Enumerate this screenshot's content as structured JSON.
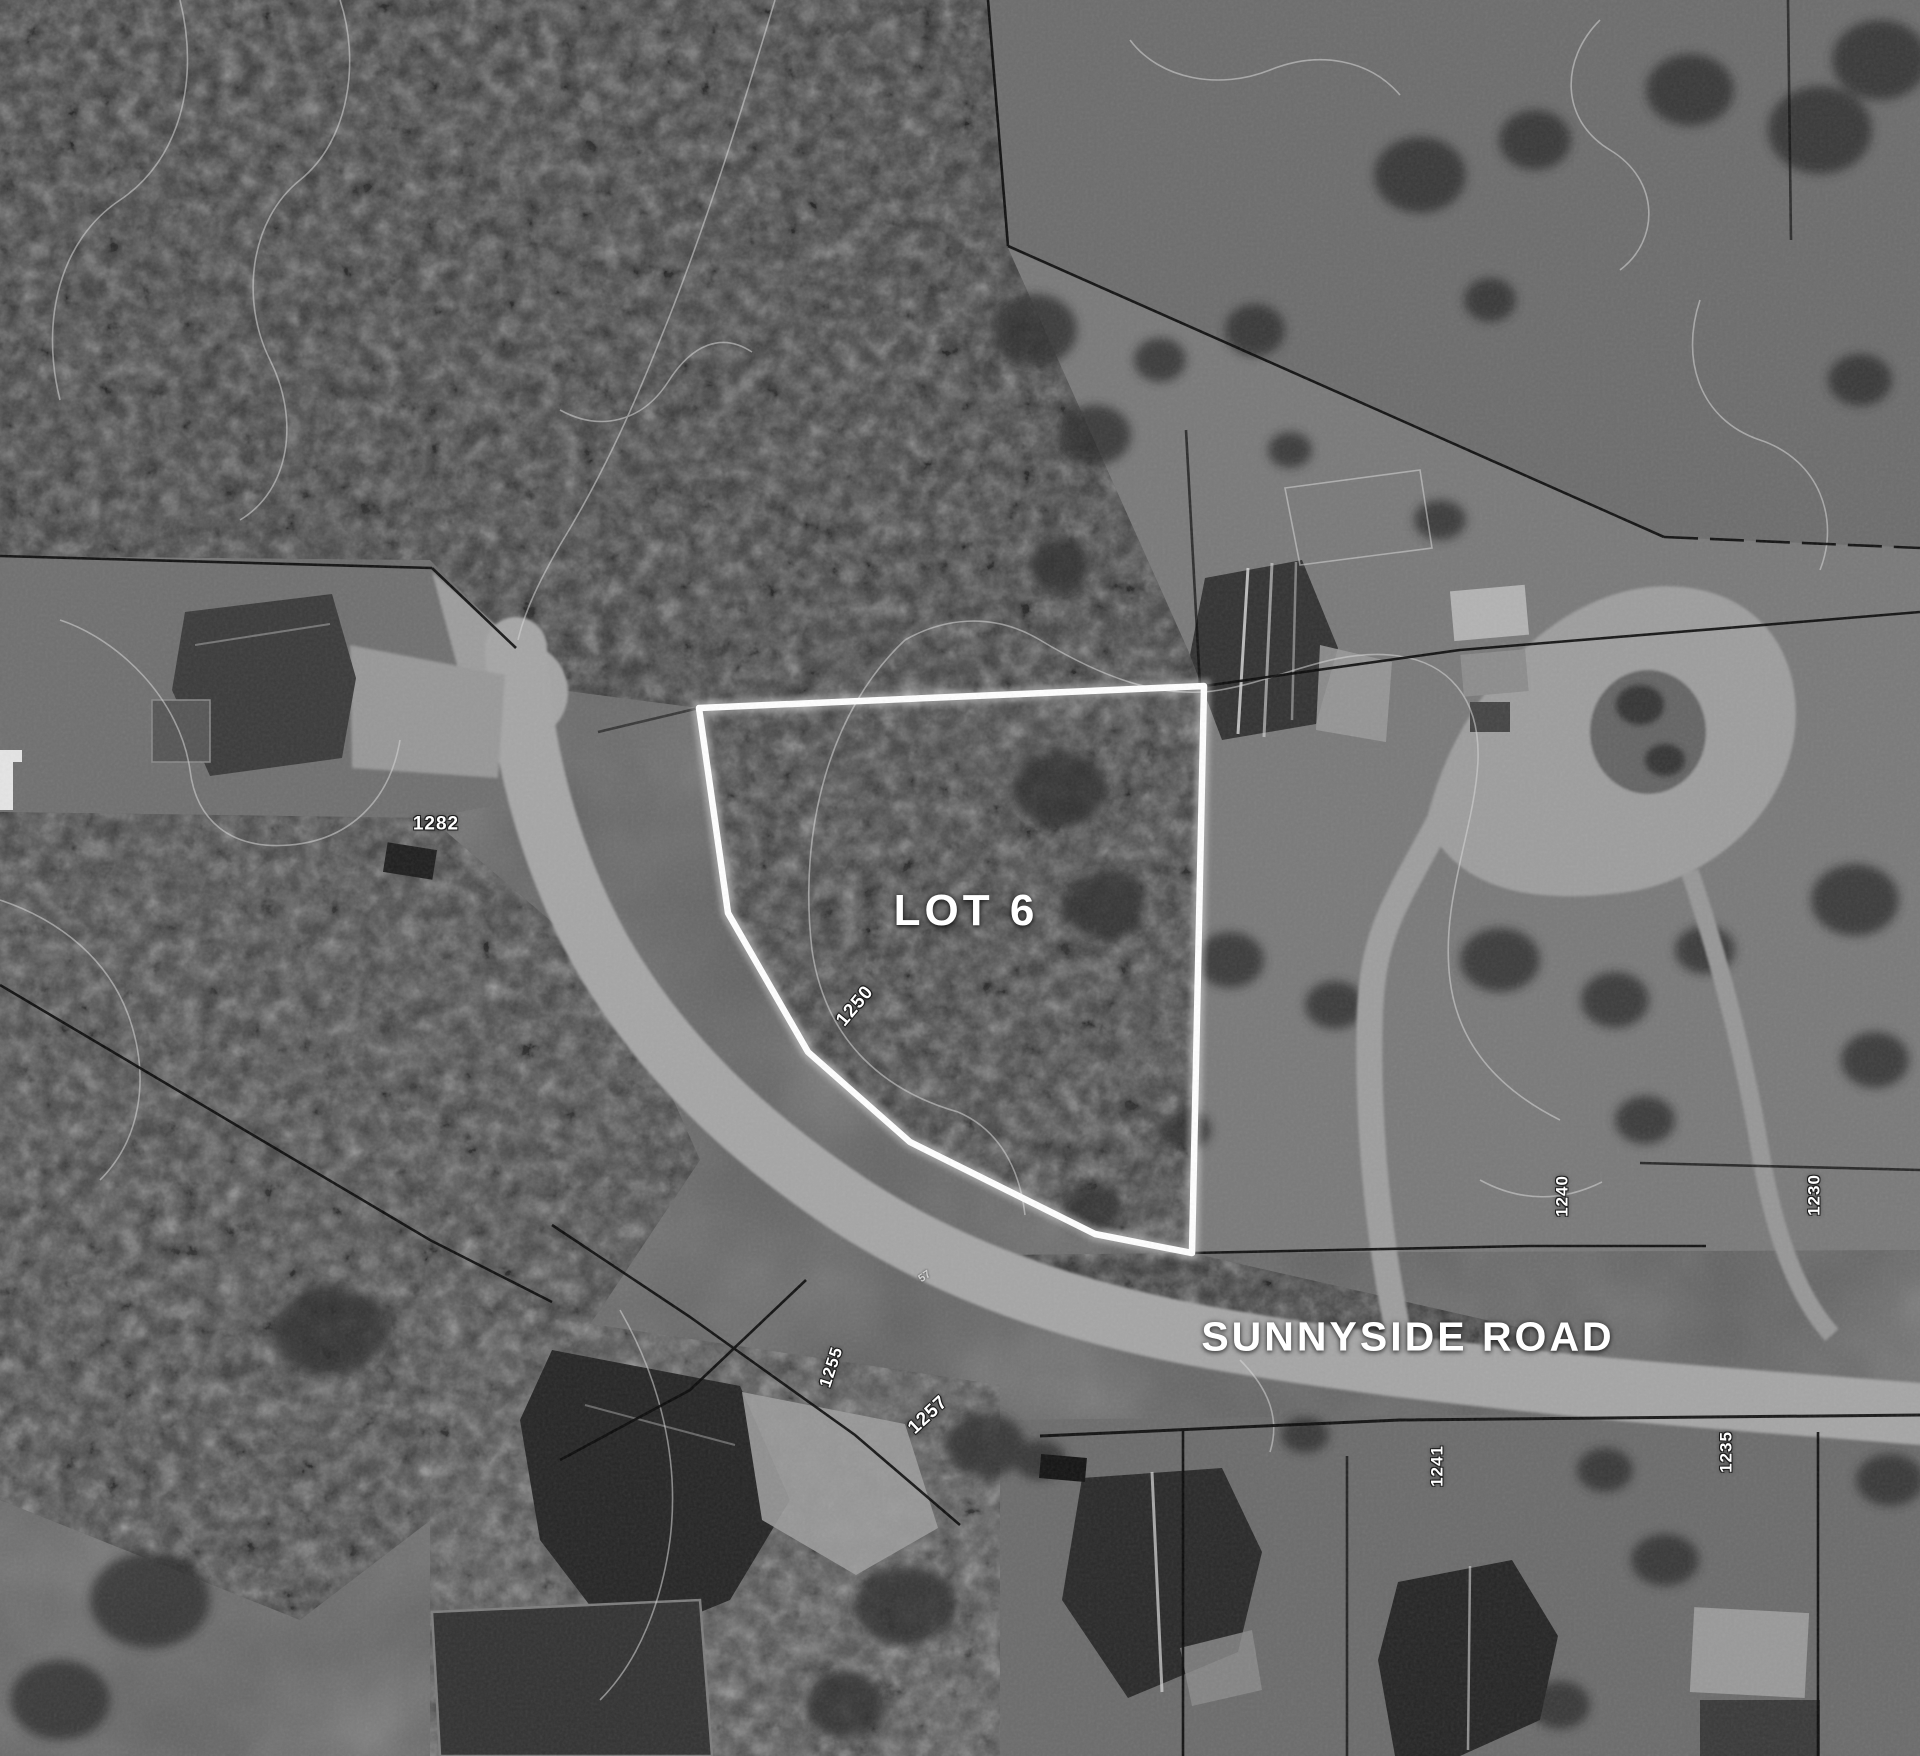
{
  "map": {
    "lot_label": "LOT 6",
    "road_label": "SUNNYSIDE ROAD",
    "road_marker": "57",
    "addresses": {
      "a1282": "1282",
      "a1250": "1250",
      "a1240": "1240",
      "a1230": "1230",
      "a1255": "1255",
      "a1257": "1257",
      "a1241": "1241",
      "a1235": "1235"
    },
    "colors": {
      "lot_outline": "#ffffff",
      "parcel_line": "#0a0a0a",
      "road_fill": "#a6a6a6",
      "label_text": "#ffffff"
    }
  }
}
